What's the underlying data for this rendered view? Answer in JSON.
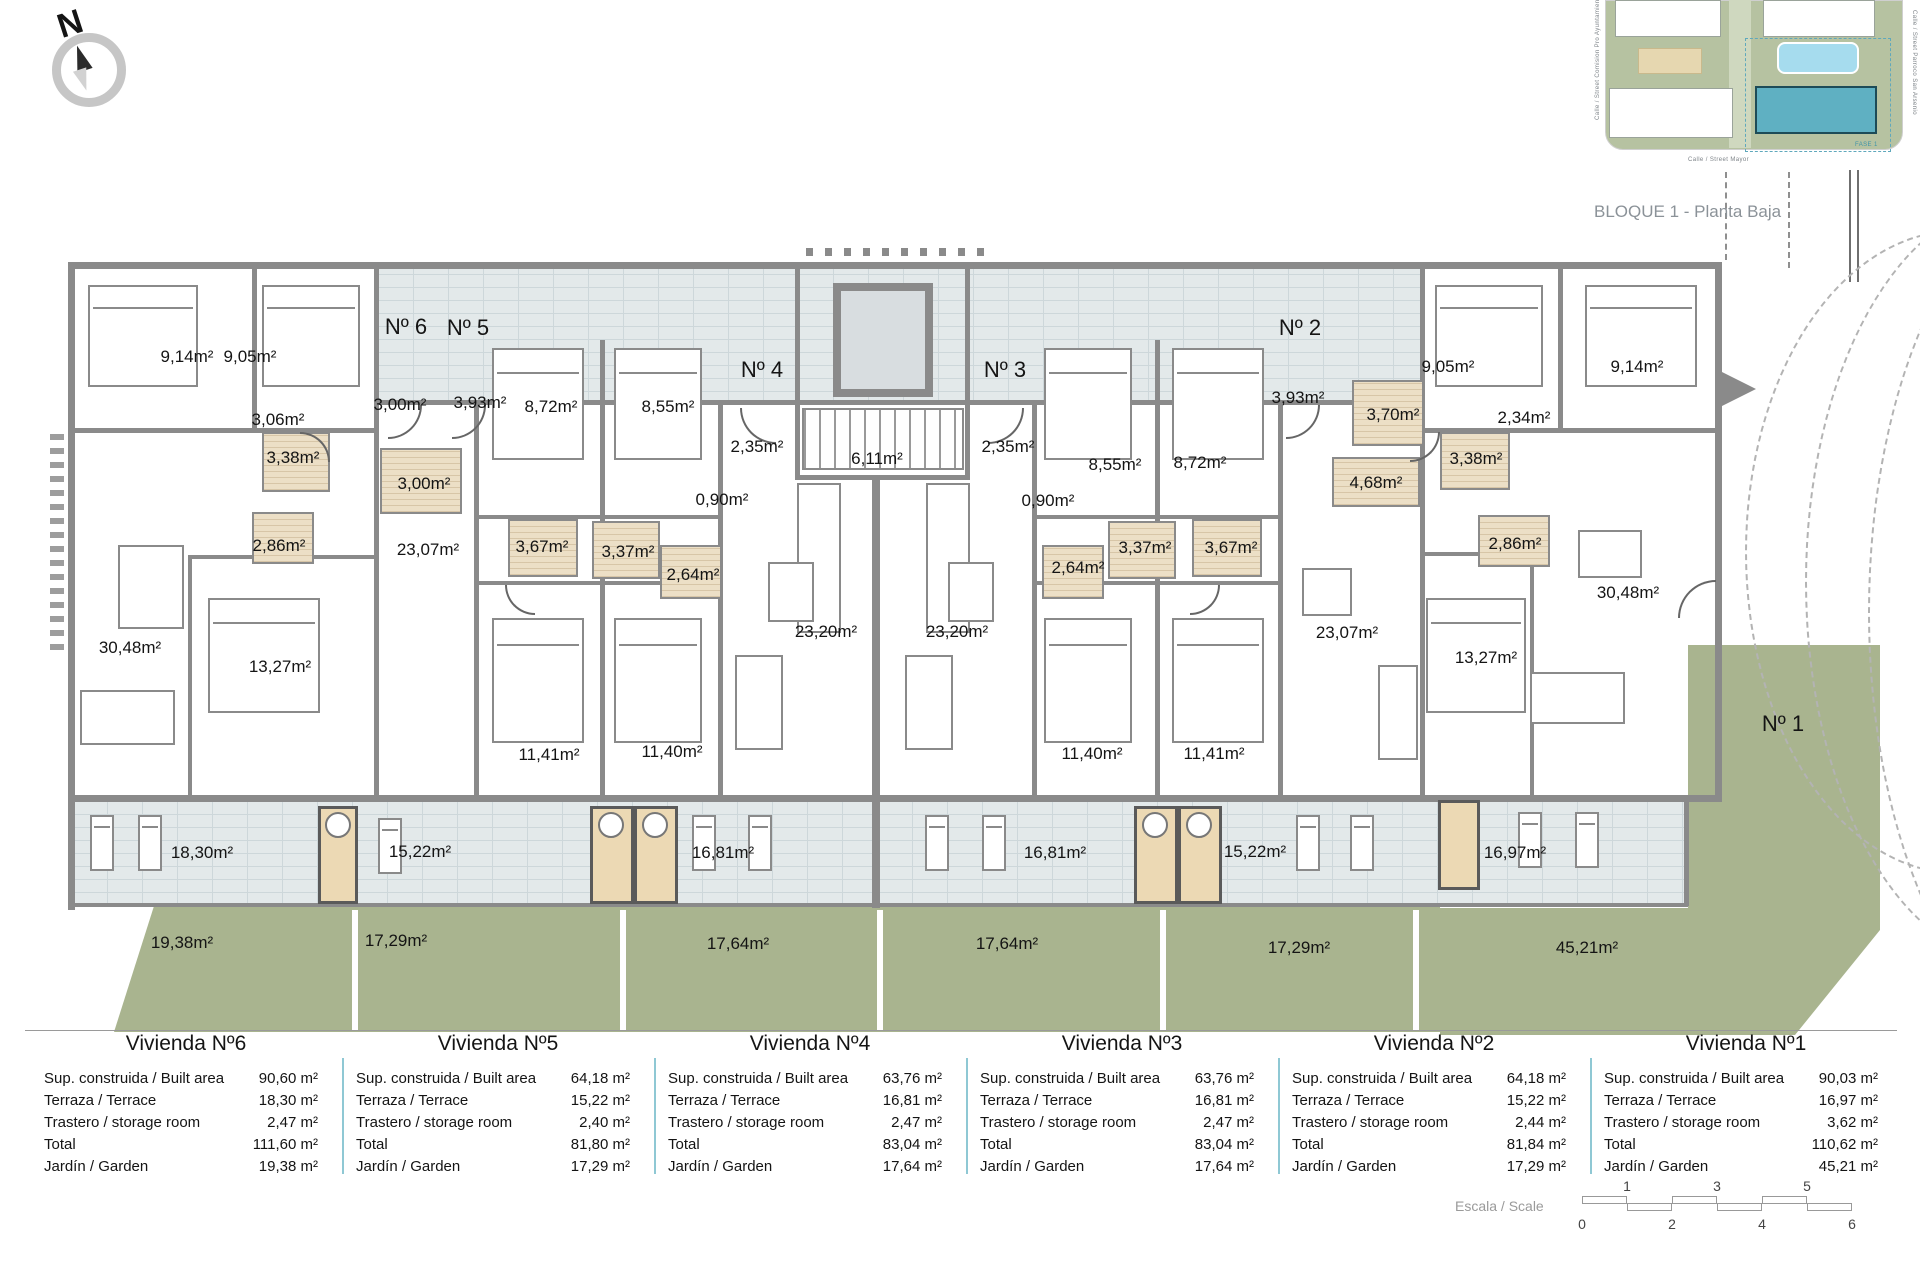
{
  "title": {
    "block_label": "BLOQUE 1 - Planta Baja"
  },
  "compass": {
    "north_label": "N"
  },
  "site_map": {
    "street_left": "Calle / Street  Comision Pro Ayuntamiento",
    "street_right": "Calle / Street  Parroco San Arsenio",
    "street_bottom": "Calle / Street  Mayor",
    "phase_label": "FASE 1",
    "highlight_color": "#5fb0c2",
    "pool_color": "#a6dcee"
  },
  "plan": {
    "labels": [
      {
        "t": "Nº 6",
        "x": 406,
        "y": 327,
        "k": "unit"
      },
      {
        "t": "Nº 5",
        "x": 468,
        "y": 328,
        "k": "unit"
      },
      {
        "t": "Nº 4",
        "x": 762,
        "y": 370,
        "k": "unit"
      },
      {
        "t": "Nº 3",
        "x": 1005,
        "y": 370,
        "k": "unit"
      },
      {
        "t": "Nº 2",
        "x": 1300,
        "y": 328,
        "k": "unit"
      },
      {
        "t": "Nº 1",
        "x": 1783,
        "y": 724,
        "k": "unit"
      },
      {
        "t": "9,14m²",
        "x": 187,
        "y": 357,
        "k": "room"
      },
      {
        "t": "9,05m²",
        "x": 250,
        "y": 357,
        "k": "room"
      },
      {
        "t": "3,06m²",
        "x": 278,
        "y": 420,
        "k": "room"
      },
      {
        "t": "3,38m²",
        "x": 293,
        "y": 458,
        "k": "room"
      },
      {
        "t": "2,86m²",
        "x": 279,
        "y": 546,
        "k": "room"
      },
      {
        "t": "30,48m²",
        "x": 130,
        "y": 648,
        "k": "room"
      },
      {
        "t": "13,27m²",
        "x": 280,
        "y": 667,
        "k": "room"
      },
      {
        "t": "3,00m²",
        "x": 400,
        "y": 405,
        "k": "room"
      },
      {
        "t": "3,00m²",
        "x": 424,
        "y": 484,
        "k": "room"
      },
      {
        "t": "3,93m²",
        "x": 480,
        "y": 403,
        "k": "room"
      },
      {
        "t": "8,72m²",
        "x": 551,
        "y": 407,
        "k": "room"
      },
      {
        "t": "8,55m²",
        "x": 668,
        "y": 407,
        "k": "room"
      },
      {
        "t": "3,67m²",
        "x": 542,
        "y": 547,
        "k": "room"
      },
      {
        "t": "3,37m²",
        "x": 628,
        "y": 552,
        "k": "room"
      },
      {
        "t": "23,07m²",
        "x": 428,
        "y": 550,
        "k": "room"
      },
      {
        "t": "11,41m²",
        "x": 549,
        "y": 755,
        "k": "room"
      },
      {
        "t": "11,40m²",
        "x": 672,
        "y": 752,
        "k": "room"
      },
      {
        "t": "2,35m²",
        "x": 757,
        "y": 447,
        "k": "room"
      },
      {
        "t": "0,90m²",
        "x": 722,
        "y": 500,
        "k": "room"
      },
      {
        "t": "2,64m²",
        "x": 693,
        "y": 575,
        "k": "room"
      },
      {
        "t": "6,11m²",
        "x": 877,
        "y": 459,
        "k": "room"
      },
      {
        "t": "23,20m²",
        "x": 826,
        "y": 632,
        "k": "room"
      },
      {
        "t": "23,20m²",
        "x": 957,
        "y": 632,
        "k": "room"
      },
      {
        "t": "2,35m²",
        "x": 1008,
        "y": 447,
        "k": "room"
      },
      {
        "t": "0,90m²",
        "x": 1048,
        "y": 501,
        "k": "room"
      },
      {
        "t": "2,64m²",
        "x": 1078,
        "y": 568,
        "k": "room"
      },
      {
        "t": "3,37m²",
        "x": 1145,
        "y": 548,
        "k": "room"
      },
      {
        "t": "3,67m²",
        "x": 1231,
        "y": 548,
        "k": "room"
      },
      {
        "t": "8,55m²",
        "x": 1115,
        "y": 465,
        "k": "room"
      },
      {
        "t": "8,72m²",
        "x": 1200,
        "y": 463,
        "k": "room"
      },
      {
        "t": "11,40m²",
        "x": 1092,
        "y": 754,
        "k": "room"
      },
      {
        "t": "11,41m²",
        "x": 1214,
        "y": 754,
        "k": "room"
      },
      {
        "t": "3,93m²",
        "x": 1298,
        "y": 398,
        "k": "room"
      },
      {
        "t": "3,70m²",
        "x": 1393,
        "y": 415,
        "k": "room"
      },
      {
        "t": "4,68m²",
        "x": 1376,
        "y": 483,
        "k": "room"
      },
      {
        "t": "23,07m²",
        "x": 1347,
        "y": 633,
        "k": "room"
      },
      {
        "t": "13,27m²",
        "x": 1486,
        "y": 658,
        "k": "room"
      },
      {
        "t": "9,05m²",
        "x": 1448,
        "y": 367,
        "k": "room"
      },
      {
        "t": "9,14m²",
        "x": 1637,
        "y": 367,
        "k": "room"
      },
      {
        "t": "2,34m²",
        "x": 1524,
        "y": 418,
        "k": "room"
      },
      {
        "t": "3,38m²",
        "x": 1476,
        "y": 459,
        "k": "room"
      },
      {
        "t": "2,86m²",
        "x": 1515,
        "y": 544,
        "k": "room"
      },
      {
        "t": "30,48m²",
        "x": 1628,
        "y": 593,
        "k": "room"
      },
      {
        "t": "18,30m²",
        "x": 202,
        "y": 853,
        "k": "terrace"
      },
      {
        "t": "15,22m²",
        "x": 420,
        "y": 852,
        "k": "terrace"
      },
      {
        "t": "16,81m²",
        "x": 723,
        "y": 853,
        "k": "terrace"
      },
      {
        "t": "16,81m²",
        "x": 1055,
        "y": 853,
        "k": "terrace"
      },
      {
        "t": "15,22m²",
        "x": 1255,
        "y": 852,
        "k": "terrace"
      },
      {
        "t": "16,97m²",
        "x": 1515,
        "y": 853,
        "k": "terrace"
      },
      {
        "t": "19,38m²",
        "x": 182,
        "y": 943,
        "k": "garden"
      },
      {
        "t": "17,29m²",
        "x": 396,
        "y": 941,
        "k": "garden"
      },
      {
        "t": "17,64m²",
        "x": 738,
        "y": 944,
        "k": "garden"
      },
      {
        "t": "17,64m²",
        "x": 1007,
        "y": 944,
        "k": "garden"
      },
      {
        "t": "17,29m²",
        "x": 1299,
        "y": 948,
        "k": "garden"
      },
      {
        "t": "45,21m²",
        "x": 1587,
        "y": 948,
        "k": "garden"
      }
    ]
  },
  "tables": {
    "row_labels": [
      "Sup. construida / Built area",
      "Terraza / Terrace",
      "Trastero / storage room",
      "Total",
      "Jardín / Garden"
    ],
    "units": [
      {
        "title": "Vivienda Nº6",
        "values": [
          "90,60 m²",
          "18,30 m²",
          "2,47 m²",
          "111,60 m²",
          "19,38 m²"
        ]
      },
      {
        "title": "Vivienda Nº5",
        "values": [
          "64,18 m²",
          "15,22 m²",
          "2,40 m²",
          "81,80 m²",
          "17,29 m²"
        ]
      },
      {
        "title": "Vivienda Nº4",
        "values": [
          "63,76 m²",
          "16,81 m²",
          "2,47 m²",
          "83,04 m²",
          "17,64 m²"
        ]
      },
      {
        "title": "Vivienda Nº3",
        "values": [
          "63,76 m²",
          "16,81 m²",
          "2,47 m²",
          "83,04 m²",
          "17,64 m²"
        ]
      },
      {
        "title": "Vivienda Nº2",
        "values": [
          "64,18 m²",
          "15,22 m²",
          "2,44 m²",
          "81,84 m²",
          "17,29 m²"
        ]
      },
      {
        "title": "Vivienda Nº1",
        "values": [
          "90,03 m²",
          "16,97 m²",
          "3,62 m²",
          "110,62 m²",
          "45,21 m²"
        ]
      }
    ]
  },
  "scale": {
    "label": "Escala / Scale",
    "ticks_top": [
      "1",
      "3",
      "5"
    ],
    "ticks_bottom": [
      "0",
      "2",
      "4",
      "6"
    ]
  },
  "colors": {
    "wall_gray": "#8a8a8a",
    "garden_green": "#a9b48f",
    "terrace_brick": "#e3e9ea",
    "wet_room_beige": "#ecdfc6",
    "table_separator_teal": "#8fc8d4",
    "caption_gray": "#8b9298"
  }
}
